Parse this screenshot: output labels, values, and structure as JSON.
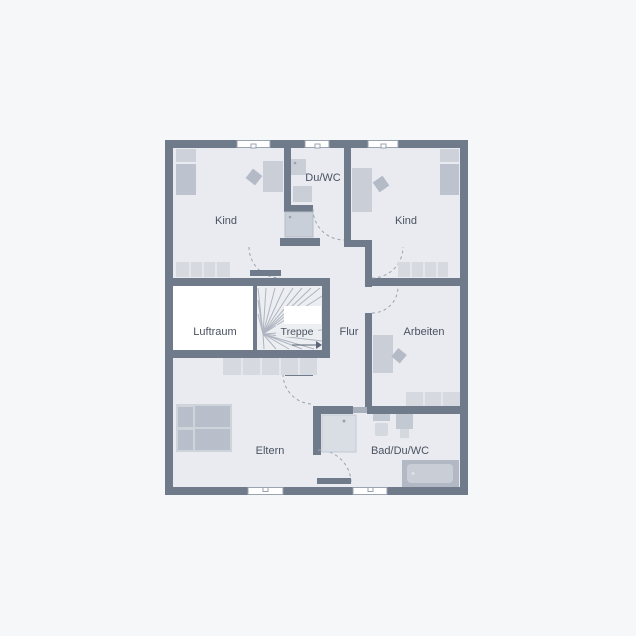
{
  "canvas": {
    "width": 636,
    "height": 636,
    "background": "#f6f7f9"
  },
  "plan": {
    "colors": {
      "wall": "#6f7a8a",
      "floor": "#e9ebf0",
      "void": "#ffffff",
      "furniture": "#c9ced7",
      "furniture_light": "#d6dae0",
      "furniture_dark": "#b4bbc7",
      "bathtub": "#b2b9c5",
      "door_arc": "#9aa3b0",
      "stair_tread": "#aeb5c0",
      "label_text": "#4a5260",
      "window_frame": "#9aa3b0"
    },
    "rooms": {
      "kind_left": {
        "label": "Kind"
      },
      "du_wc": {
        "label": "Du/WC"
      },
      "kind_right": {
        "label": "Kind"
      },
      "luftraum": {
        "label": "Luftraum"
      },
      "treppe": {
        "label": "Treppe"
      },
      "flur": {
        "label": "Flur"
      },
      "arbeiten": {
        "label": "Arbeiten"
      },
      "eltern": {
        "label": "Eltern"
      },
      "bad": {
        "label": "Bad/Du/WC"
      }
    }
  }
}
